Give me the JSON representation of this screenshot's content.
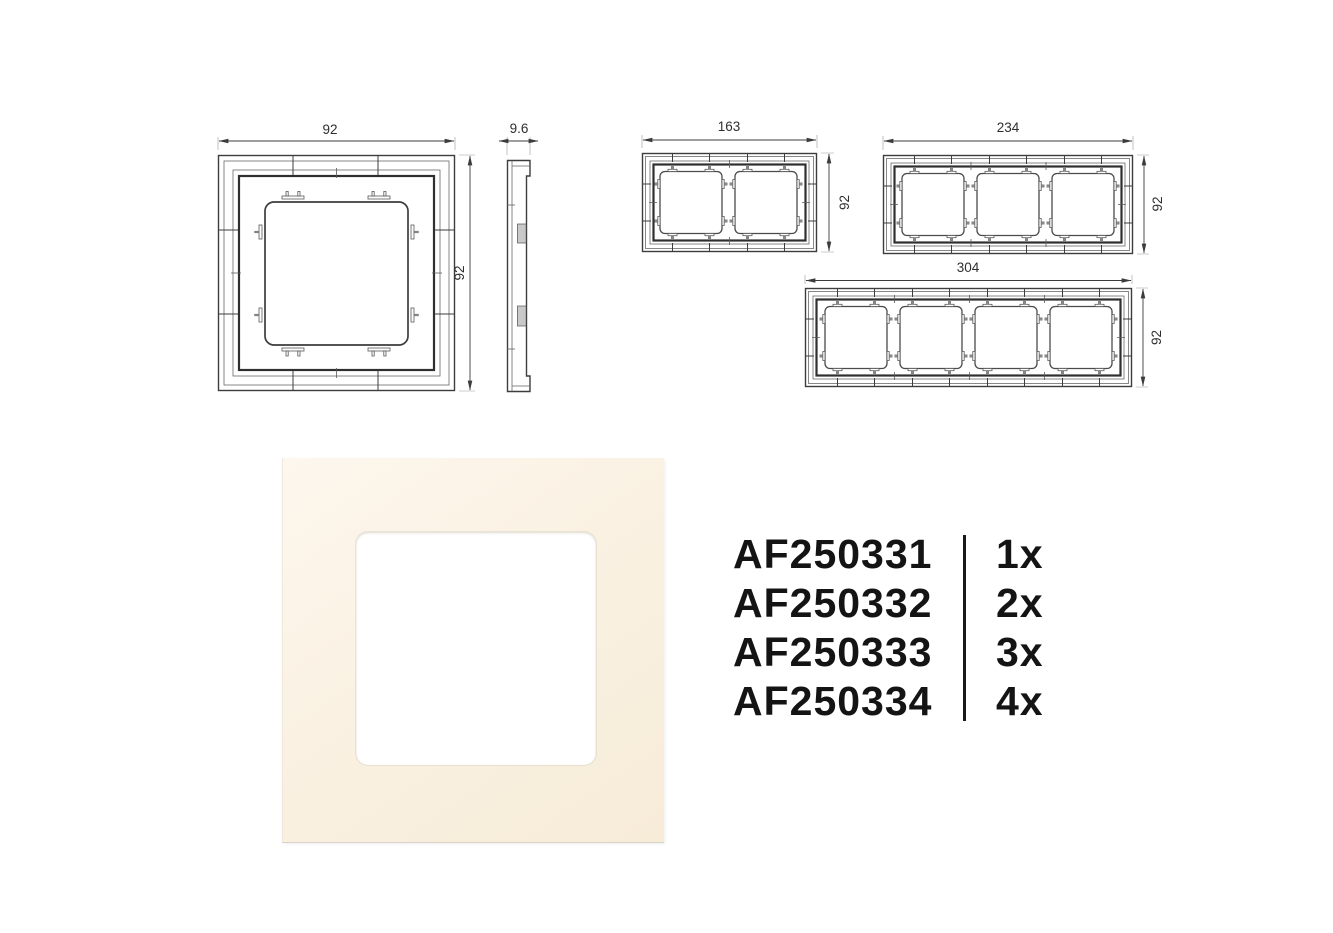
{
  "colors": {
    "drawing_line": "#3d3d3d",
    "dimension_text": "#2e2e2e",
    "photo_frame_cream": "#f9efde",
    "photo_opening_white": "#ffffff",
    "parts_text": "#141414",
    "page_background": "#ffffff"
  },
  "drawings": {
    "one_gang_front": {
      "width": "92",
      "height": "92"
    },
    "side_profile": {
      "depth": "9.6"
    },
    "two_gang_front": {
      "width": "163",
      "height": "92"
    },
    "three_gang_front": {
      "width": "234",
      "height": "92"
    },
    "four_gang_front": {
      "width": "304",
      "height": "92"
    }
  },
  "parts_list": {
    "rows": [
      {
        "code": "AF250331",
        "qty": "1x"
      },
      {
        "code": "AF250332",
        "qty": "2x"
      },
      {
        "code": "AF250333",
        "qty": "3x"
      },
      {
        "code": "AF250334",
        "qty": "4x"
      }
    ]
  }
}
